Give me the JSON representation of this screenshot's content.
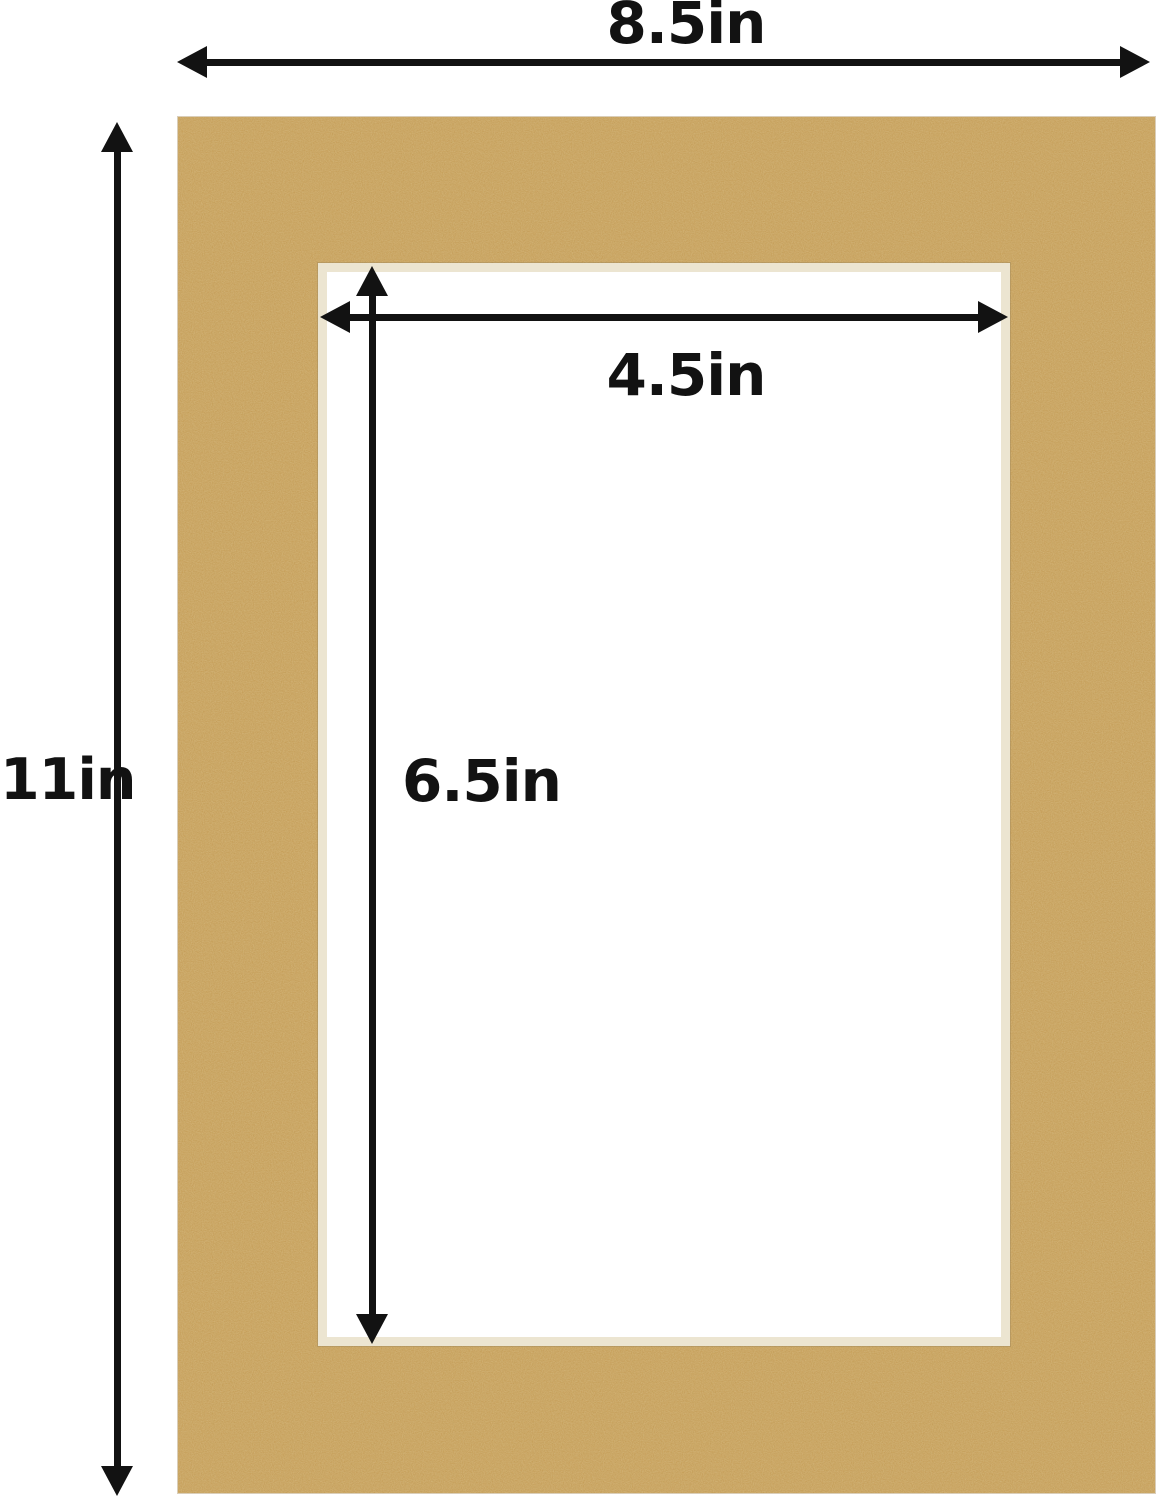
{
  "colors": {
    "background": "#ffffff",
    "mat": "#c59b53",
    "bevel": "#ece5d1",
    "opening": "#ffffff",
    "annotation": "#121212"
  },
  "diagram": {
    "dimensions": {
      "outer_width": {
        "label": "8.5in"
      },
      "outer_height": {
        "label": "11in"
      },
      "opening_width": {
        "label": "4.5in"
      },
      "opening_height": {
        "label": "6.5in"
      }
    }
  }
}
